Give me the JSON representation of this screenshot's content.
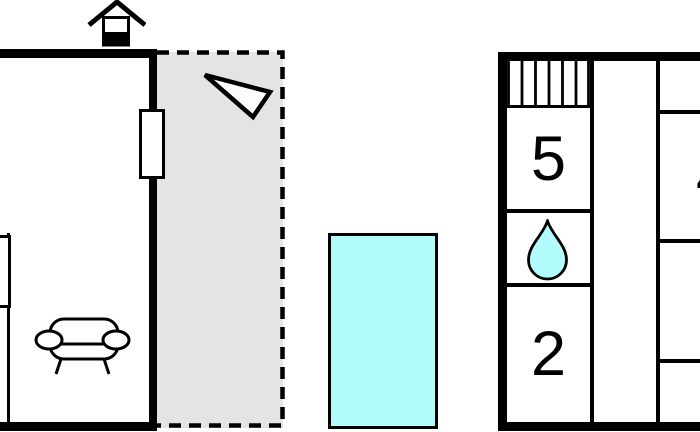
{
  "meta": {
    "type": "floor-plan",
    "background": "#ffffff"
  },
  "colors": {
    "wall": "#000000",
    "terrace_fill": "#e4e4e4",
    "water": "#b2fcfc",
    "paper": "#ffffff"
  },
  "living_area": {
    "entrance_marker": "house-icon",
    "furniture": [
      {
        "icon": "sofa-icon"
      }
    ],
    "windows": [
      {
        "side": "right"
      },
      {
        "side": "left"
      }
    ]
  },
  "terrace": {
    "fill": "#e4e4e4",
    "border_style": "dashed",
    "marker_icon": "direction-triangle-icon"
  },
  "pool": {
    "shape": "rectangle",
    "fill": "#b2fcfc"
  },
  "annex": {
    "stairs_icon": "stairs-icon",
    "rooms": [
      {
        "id": "room-top",
        "label": "5"
      },
      {
        "id": "bathroom",
        "icon": "water-drop-icon"
      },
      {
        "id": "room-bottom",
        "label": "2"
      },
      {
        "id": "room-edge-partial",
        "label": "4"
      }
    ]
  }
}
